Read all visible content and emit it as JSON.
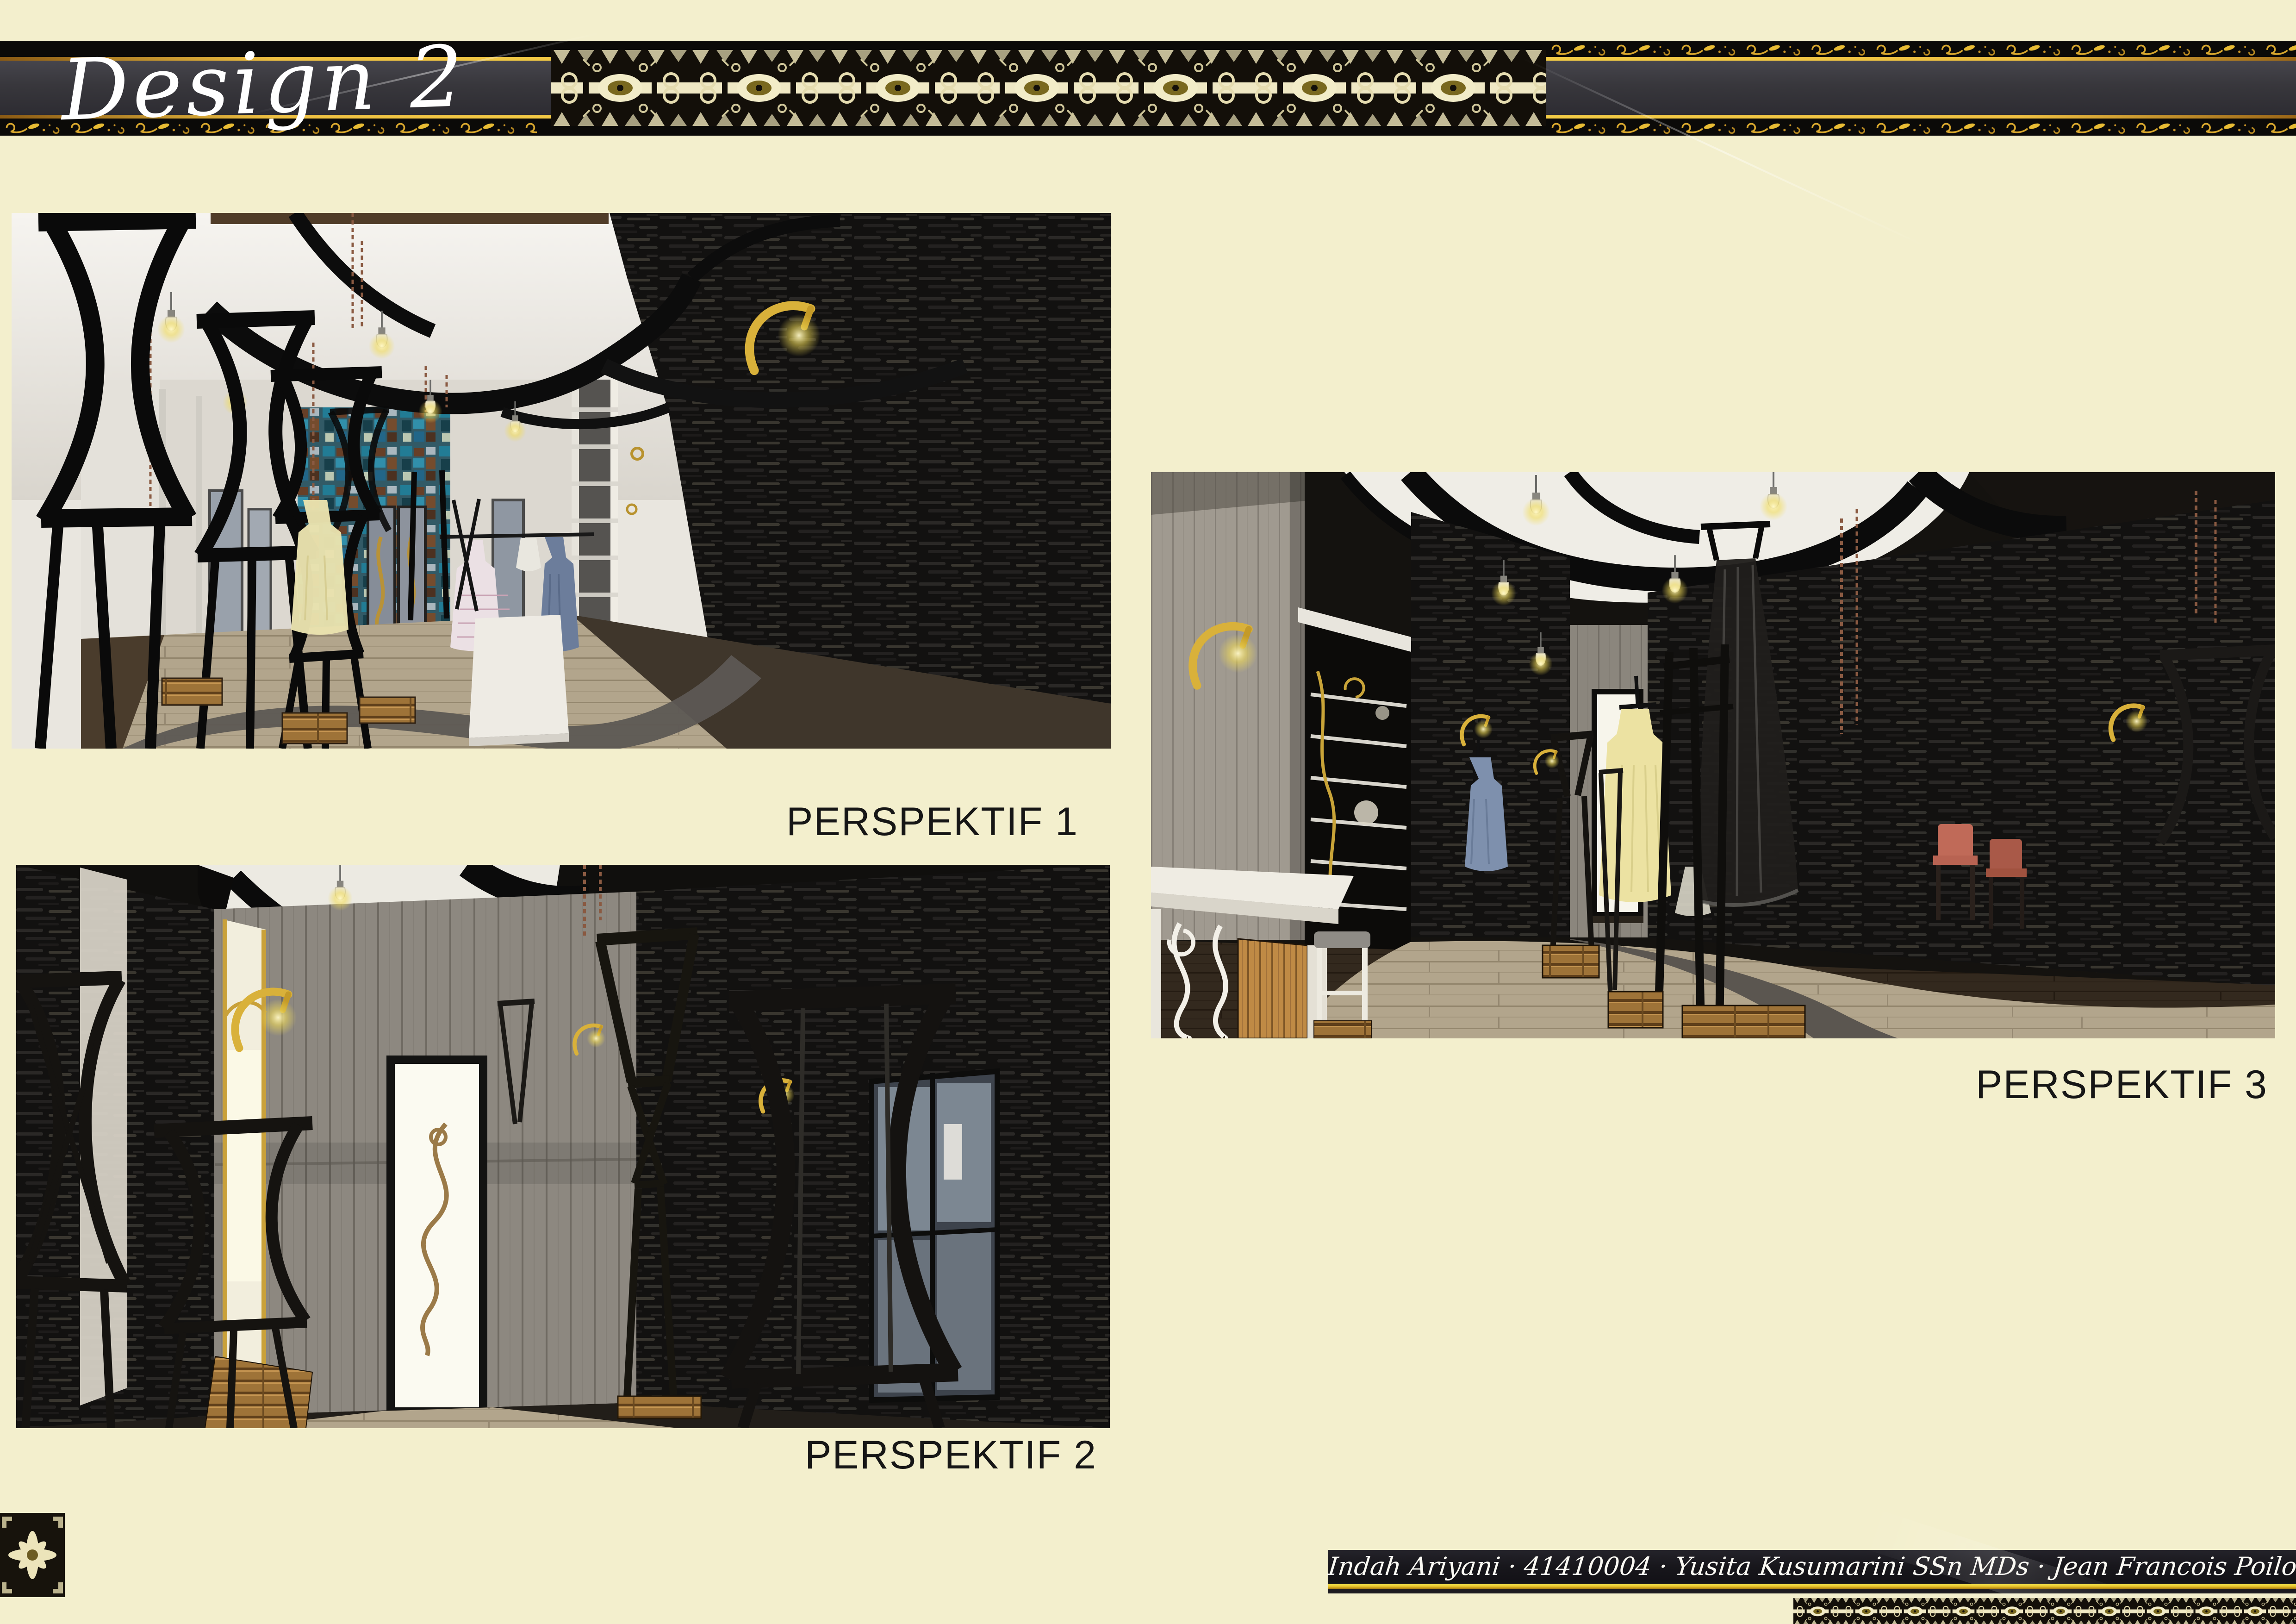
{
  "header": {
    "title": "Design 2"
  },
  "perspectives": [
    {
      "label": "PERSPEKTIF 1"
    },
    {
      "label": "PERSPEKTIF 2"
    },
    {
      "label": "PERSPEKTIF 3"
    }
  ],
  "footer": {
    "credits": "Indah Ariyani · 41410004 · Yusita Kusumarini SSn MDs · Jean Francois Poilot ST · Tugas Akhir",
    "segments": [
      "Indah Ariyani",
      "41410004",
      "Yusita Kusumarini SSn MDs",
      "Jean Francois Poilot ST",
      "Tugas Akhir"
    ]
  },
  "ornaments": {
    "header_pattern": "batik-ikat-band",
    "header_scrolls": "gold-floral-scroll",
    "corner_bottom_left": "batik-medallion",
    "corner_bottom_right": "batik-strip"
  },
  "colors": {
    "page_background": "#f3efcd",
    "header_black": "#0b0a08",
    "header_charcoal": "#38373c",
    "gold": "#eec042",
    "label_text": "#161616",
    "footer_yellow": "#e9c82f",
    "batik_cream": "#efe8c4"
  },
  "renders": [
    {
      "name": "perspective-1",
      "description": "boutique interior, black hourglass racks, white ceiling with black curved ribbons, mosaic wall, wooden floor"
    },
    {
      "name": "perspective-2",
      "description": "corridor with black stone walls, grey plank wall, white door with swirl ornament, gold lamps"
    },
    {
      "name": "perspective-3",
      "description": "boutique aisle with white cashier desk, hanging dresses, curved floor paths"
    }
  ]
}
